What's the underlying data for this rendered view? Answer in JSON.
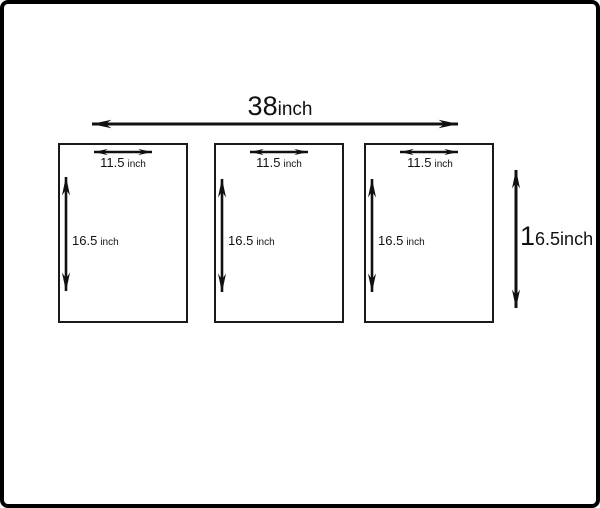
{
  "colors": {
    "ink": "#111111",
    "panel_border": "#1a1a1a",
    "frame_border": "#000000",
    "background": "#ffffff"
  },
  "top_dimension": {
    "value": "38",
    "unit": "inch"
  },
  "right_dimension": {
    "value_lead": "1",
    "value_rest": "6.5inch"
  },
  "panels": [
    {
      "width_value": "11.5",
      "width_unit": "inch",
      "height_value": "16.5",
      "height_unit": "inch"
    },
    {
      "width_value": "11.5",
      "width_unit": "inch",
      "height_value": "16.5",
      "height_unit": "inch"
    },
    {
      "width_value": "11.5",
      "width_unit": "inch",
      "height_value": "16.5",
      "height_unit": "inch"
    }
  ]
}
